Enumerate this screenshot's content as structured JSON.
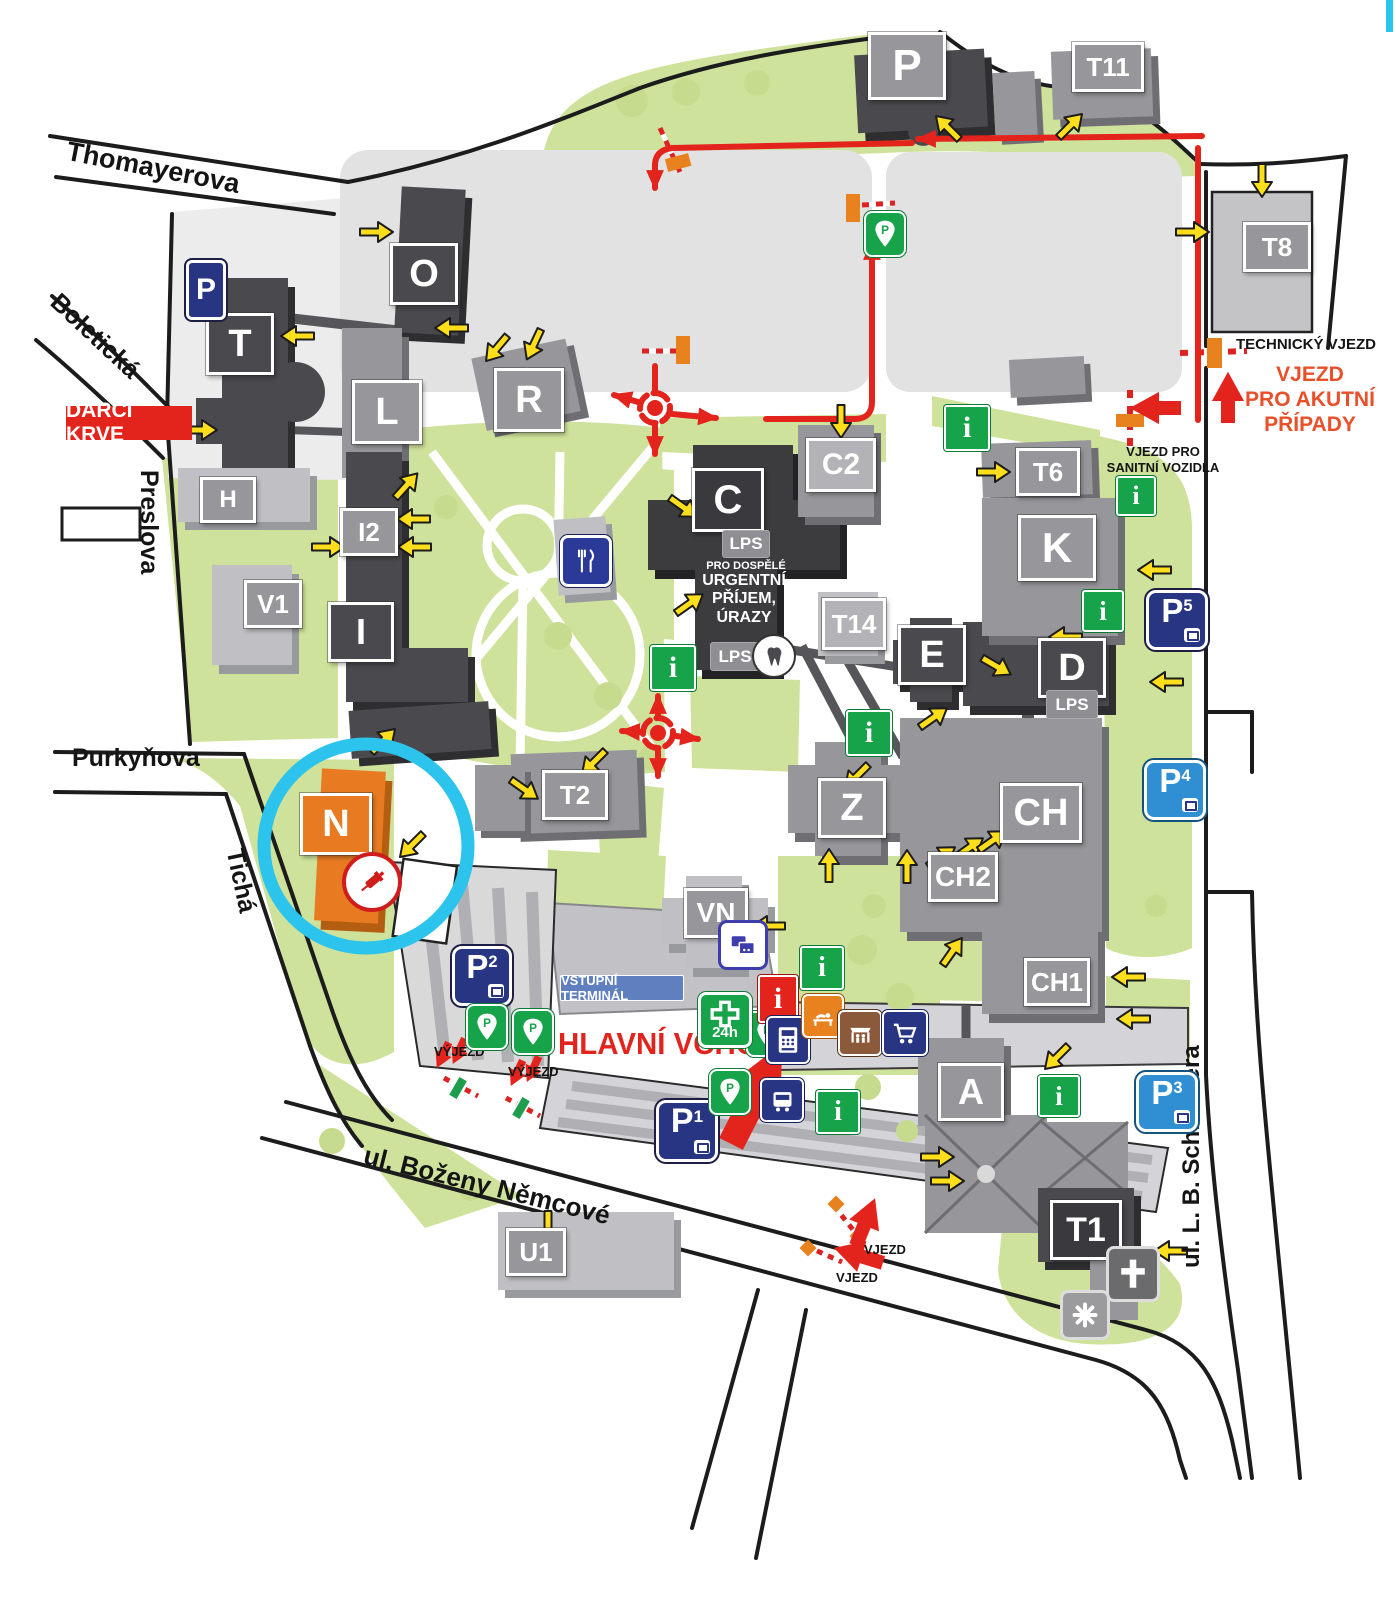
{
  "streets": {
    "thomayerova": "Thomayerova",
    "boleticka": "Boletická",
    "preslova": "Preslova",
    "purkynova": "Purkyňova",
    "ticha": "Tichá",
    "bozeny_nemcove": "ul. Boženy Němcové",
    "schneidera": "ul. L. B. Schneidera"
  },
  "buildings": {
    "p_garage": "P",
    "t11": "T11",
    "t8": "T8",
    "o": "O",
    "t": "T",
    "l": "L",
    "r": "R",
    "h": "H",
    "i2": "I2",
    "v1": "V1",
    "i": "I",
    "c": "C",
    "c2": "C2",
    "t14": "T14",
    "t6": "T6",
    "k": "K",
    "e": "E",
    "d": "D",
    "z": "Z",
    "ch": "CH",
    "ch2": "CH2",
    "ch1": "CH1",
    "t2": "T2",
    "n": "N",
    "vn": "VN",
    "a": "A",
    "t1": "T1",
    "u1": "U1"
  },
  "parking": {
    "street_sign": "P",
    "pin_letter": "P",
    "p1": {
      "letter": "P",
      "num": "1"
    },
    "p2": {
      "letter": "P",
      "num": "2"
    },
    "p3": {
      "letter": "P",
      "num": "3"
    },
    "p4": {
      "letter": "P",
      "num": "4"
    },
    "p5": {
      "letter": "P",
      "num": "5"
    }
  },
  "labels": {
    "darci_krve": "DÁRCI KRVE",
    "hlavni_vchod": "HLAVNÍ VCHOD",
    "technicky_vjezd": "TECHNICKÝ VJEZD",
    "vjezd_akutni": [
      "VJEZD",
      "PRO AKUTNÍ",
      "PŘÍPADY"
    ],
    "vjezd_sanitni": [
      "VJEZD PRO",
      "SANITNÍ VOZIDLA"
    ],
    "vstupni_terminal": "VSTUPNÍ TERMINÁL",
    "urgentni_prijem": [
      "URGENTNÍ",
      "PŘÍJEM,",
      "ÚRAZY"
    ],
    "lps": "LPS",
    "pro_dospele": "PRO DOSPĚLÉ",
    "pharmacy_24h": "24h",
    "vyjezd": "VÝJEZD",
    "vjezd": "VJEZD",
    "info_letter": "i"
  },
  "colors": {
    "green_area": "#cfe29b",
    "building_dark": "#4a4a4e",
    "building_gray": "#97979b",
    "building_light": "#b3b3b7",
    "n_orange": "#e87b22",
    "route_red": "#e3241d",
    "arrow_yellow": "#ffdf1b",
    "info_green": "#17a34a",
    "parking_navy": "#283583",
    "parking_blue": "#2f8fd2",
    "highlight_cyan": "#2cc4ec",
    "terminal_blue": "#5f7fbf"
  }
}
